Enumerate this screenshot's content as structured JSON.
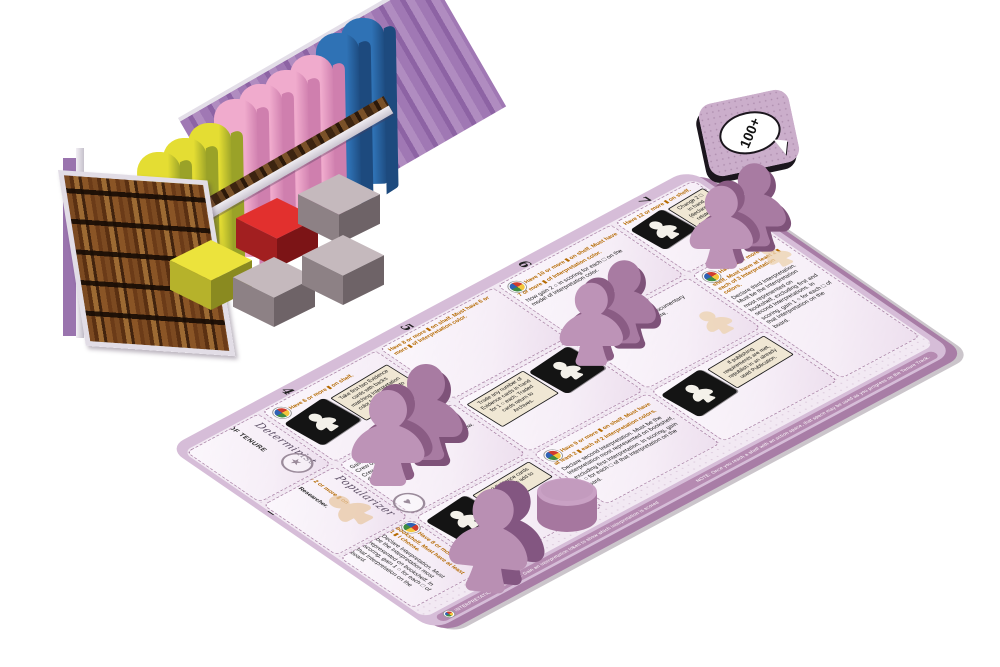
{
  "token_100": {
    "label": "100+"
  },
  "board": {
    "nums": {
      "n1": "1",
      "n2": "2",
      "n3": "3",
      "n4": "4",
      "n5": "5",
      "n6": "6",
      "n7": "7"
    },
    "start_col": {
      "s1": {
        "title": "START OF TENURE TRACK"
      },
      "s2": {
        "req": "Must have 2 or more ▮ on shelf.",
        "body": "Gain final Researcher."
      },
      "s3": {
        "req": "Have 8 or more ▮ on bookshelf. Must have at least 1 ▮ I choose.",
        "body": "Declare Interpretation. Must be the Interpretation most represented on bookshelf. In scoring, gain 1 ○ for each □ of that Interpretation on the board."
      }
    },
    "scripts": {
      "r1": "Determinist",
      "r2": "Popularizer"
    },
    "seals": {
      "s1": "★",
      "s2": "♥",
      "s3": "☠"
    },
    "cols": {
      "c4": {
        "r0_req": "Have 6 or more ▮ on shelf.",
        "r0_box": "Take first two Evidence cards with backs matching Interpretation color from Archives to hand.",
        "r1_body": "Gain and immediately use Documentary Crew on the board you desire. Documentary Crew: in scoring, 1 ○ for each color □ in any district where you have a Documentary Crew.",
        "r2_box": "Top 3 Evidence cards from Archives add to hand."
      },
      "c5": {
        "r0_req": "Have 8 or more ▮ on shelf. Must have 6 or more ▮ of Interpretation color.",
        "r1_box": "Trade any number of Evidence cards in hand for 1 ○ each. Traded cards return to Archives.",
        "r2_req": "Have 9 or more ▮ on shelf. Must have at least 2 ▮ each of 2 Interpretation colors.",
        "r2_body": "Declare second Interpretation. Must be the Interpretation most represented on bookshelf, excluding first Interpretation. In scoring, gain 1 ○ for each □ of that Interpretation on the board."
      },
      "c6": {
        "r0_req": "Have 10 or more ▮ on shelf. Must have 7 or more ▮ of Interpretation color.",
        "r0_body": "Now gain 2 ○ in scoring for each □ on the model of Interpretation color.",
        "r1_req": "Have 11 or more ▮ on shelf.",
        "r1_body": "Gain and immediately use Documentary Crew on the board you desire.",
        "r2_box": "If publishing requirements are met, republish in an already used Publication."
      },
      "c7": {
        "r0_req": "Have 12 or more ▮ on shelf.",
        "r0_box": "Change 2 □ in hand (declared or related) to Interpretation color.",
        "r1_req": "Have 12 or more ▮ on shelf. Must have at least 2 ▮ each of 3 Interpretation colors.",
        "r1_body": "Declare third Interpretation. Must be the Interpretation most represented on bookshelf, excluding first and second Interpretations. In scoring, gain 1 ○ for each □ of that Interpretation on the board."
      }
    },
    "edge_notes": {
      "milestone": "INTERPRETATION MILESTONE: Gain an Interpretation token to show which Interpretation is scored",
      "note": "NOTE: Once you reach a shelf with an action space, that space may be used as you progress on the Tenure Track."
    }
  },
  "bookshelf": {
    "books": [
      "yellow",
      "yellow",
      "yellow",
      "pink",
      "pink",
      "pink",
      "pink",
      "blue",
      "blue"
    ],
    "cubes": [
      "yellow",
      "red",
      "gray",
      "gray",
      "gray"
    ]
  },
  "pieces": {
    "purple_double_meeples": 3,
    "purple_single_meeples": 1,
    "purple_discs": 1
  },
  "palette": {
    "yellow": "#e4dd33",
    "pink": "#f0abcd",
    "blue": "#2f72b5",
    "red": "#de2c2a",
    "gray": "#c2b6ba",
    "board_mauve": "#d6bdd8",
    "meeple_purple": "#bd93b7"
  }
}
